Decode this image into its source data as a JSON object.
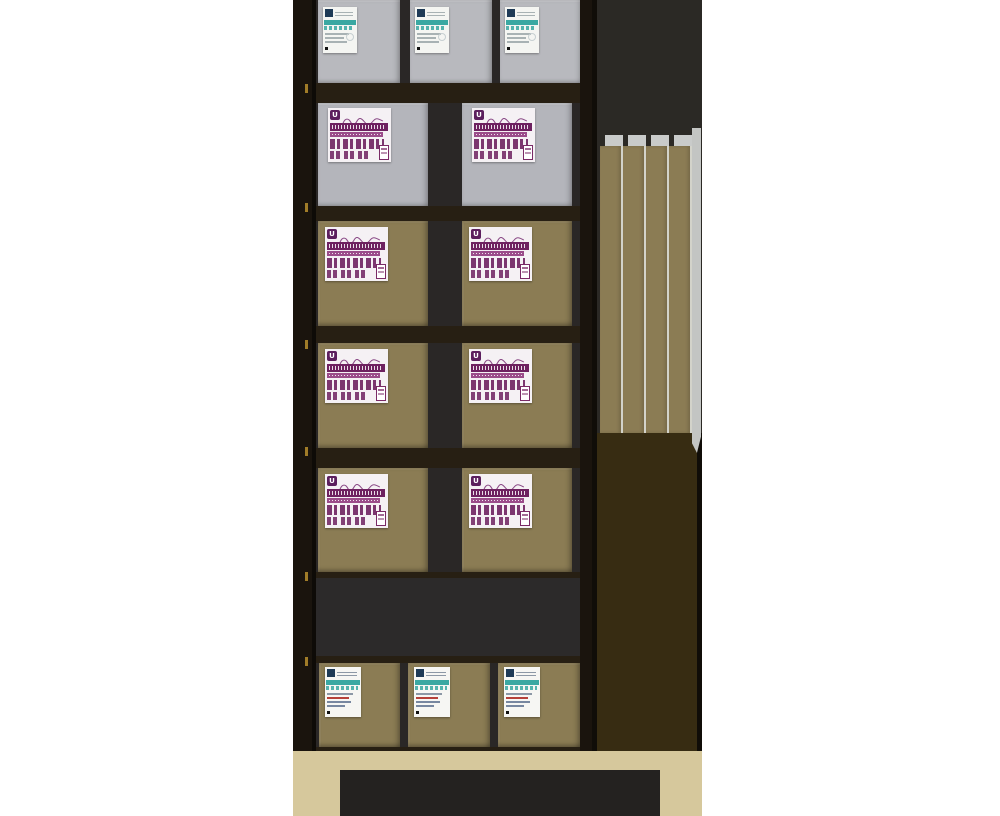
{
  "scene": {
    "background_color": "#ffffff",
    "shelf_unit": {
      "frame_color": "#271f13",
      "post_color": "#1a140d",
      "post_edge_color": "#0e0b07",
      "interior_color": "#2a2726",
      "empty_row_color": "#2c2a2a",
      "price_tag_color": "#a07c28",
      "rows": [
        {
          "id": "row-1",
          "type": "boxes",
          "box_count": 3,
          "box_color": "#b8b9be",
          "box_finish": "gray",
          "label": "teal"
        },
        {
          "id": "row-2",
          "type": "boxes",
          "box_count": 2,
          "box_color": "#b4b5bb",
          "box_finish": "gray",
          "label": "purple"
        },
        {
          "id": "row-3",
          "type": "boxes",
          "box_count": 2,
          "box_color": "#8b7c54",
          "box_finish": "khaki",
          "label": "purple"
        },
        {
          "id": "row-4",
          "type": "boxes",
          "box_count": 2,
          "box_color": "#8b7c54",
          "box_finish": "khaki",
          "label": "purple"
        },
        {
          "id": "row-5",
          "type": "boxes",
          "box_count": 2,
          "box_color": "#8b7c54",
          "box_finish": "khaki",
          "label": "purple"
        },
        {
          "id": "row-6",
          "type": "empty"
        },
        {
          "id": "row-7",
          "type": "boxes",
          "box_count": 3,
          "box_color": "#8b7c54",
          "box_finish": "khaki",
          "label": "teal_red"
        }
      ]
    },
    "labels": {
      "teal": {
        "bg": "#f4f5f2",
        "accent": "#3aa8a2",
        "logo_color": "#1e3a56",
        "text_color": "#a8b2b4",
        "circle_color": "#c6cfd1",
        "dot_color": "#111111"
      },
      "teal_red": {
        "bg": "#f6f6f3",
        "accent": "#3aa8a2",
        "logo_color": "#1e3a56",
        "red_accent": "#b5413a",
        "text_color": "#8c98a6",
        "dot_color": "#111111"
      },
      "purple": {
        "bg": "#f5f1f4",
        "band_color": "#6e2160",
        "band2_color": "#9b4c8a",
        "logo_color": "#5c1f5e",
        "logo_letter": "U",
        "script_color": "#8a4a86",
        "glyph_color": "#6e2160",
        "badge_color": "#7a2a66"
      }
    },
    "panel_bay": {
      "upper_color": "#2b2925",
      "lower_color": "#372c12",
      "edge_color": "#100d08",
      "panel_count": 4,
      "panel_color": "#8b7c54",
      "separator_color": "#d3d3ca",
      "cap_color": "#c9cbca",
      "side_wall_color": "#c3c5c3"
    },
    "floor": {
      "color": "#d6c89c",
      "mat_color": "#242220"
    }
  }
}
